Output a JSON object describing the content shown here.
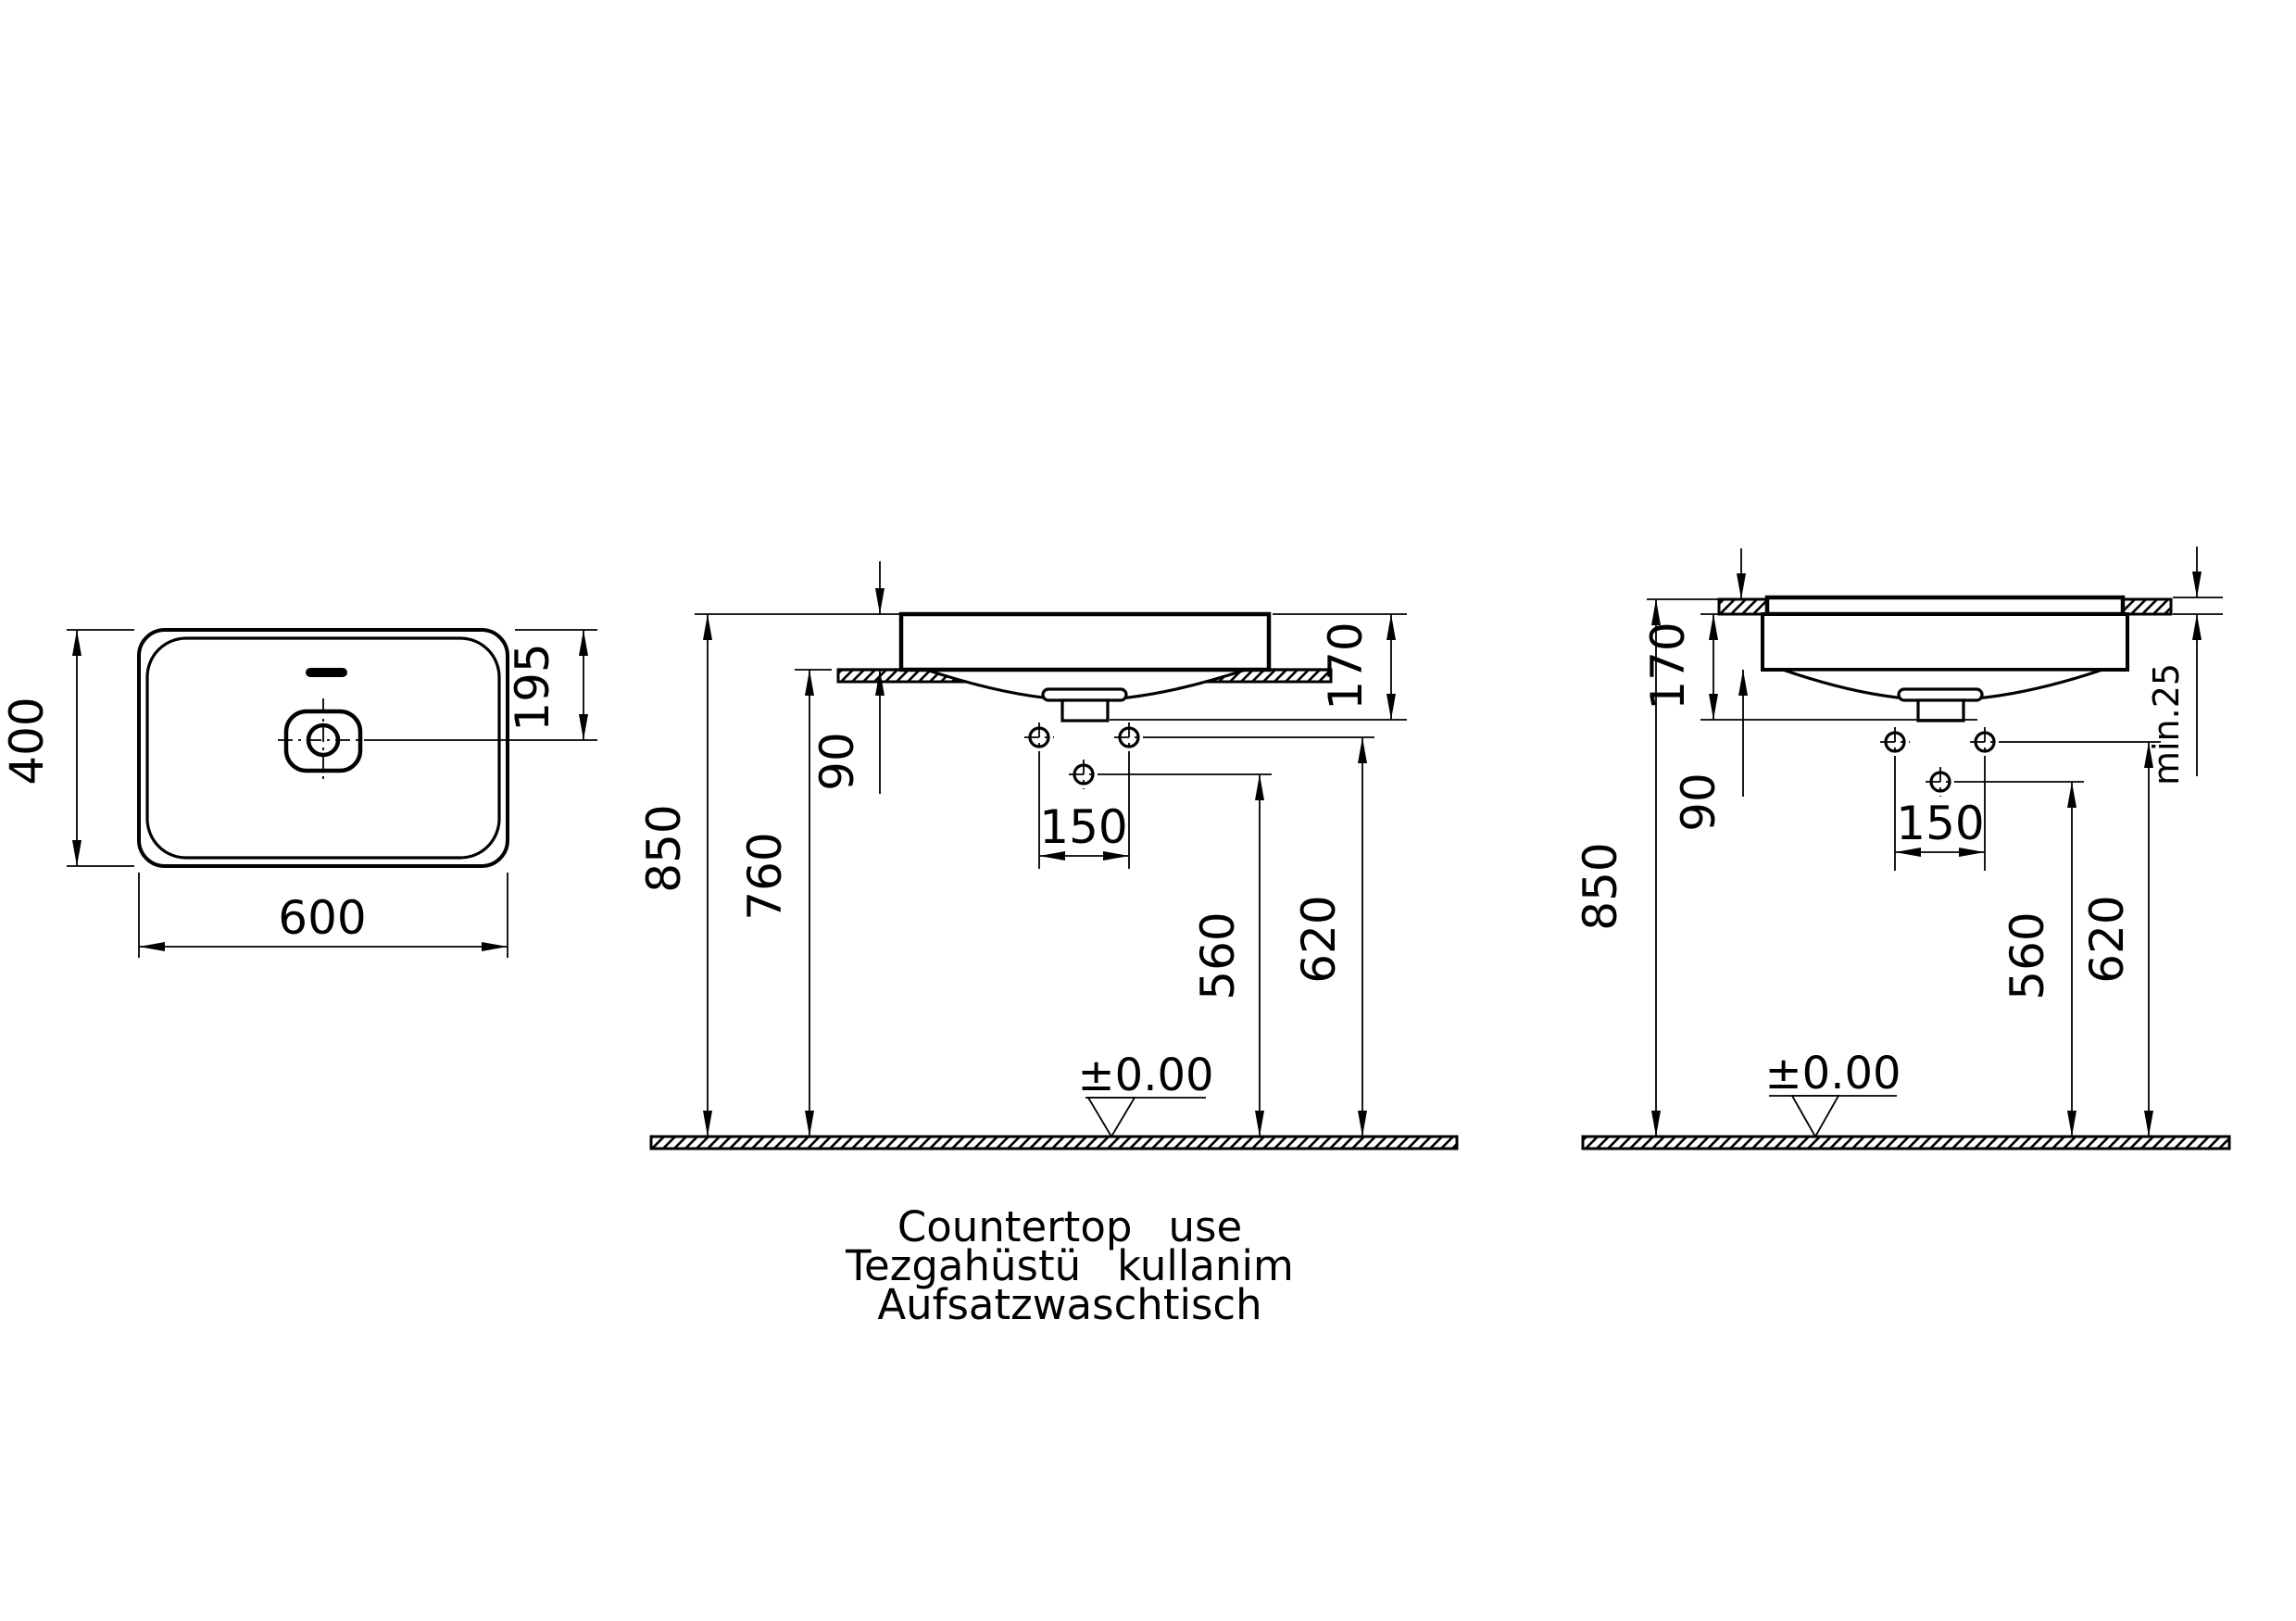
{
  "colors": {
    "line": "#000000",
    "background": "#ffffff"
  },
  "top_view": {
    "width": "600",
    "depth": "400",
    "drain_offset": "195"
  },
  "front_view": {
    "height_rim_from_floor": "850",
    "height_countertop": "760",
    "rim_above_countertop": "90",
    "basin_total_depth": "170",
    "faucet_hole_spacing": "150",
    "center_hole_height": "560",
    "side_hole_height": "620",
    "floor_datum": "±0.00"
  },
  "recessed_view": {
    "height_rim_from_floor": "850",
    "rim_above_countertop": "90",
    "basin_total_depth": "170",
    "faucet_hole_spacing": "150",
    "center_hole_height": "560",
    "side_hole_height": "620",
    "min_countertop_thickness": "min.25",
    "floor_datum": "±0.00"
  },
  "caption": {
    "line_en": "Countertop use",
    "line_tr": "Tezgahüstü kullanim",
    "line_de": "Aufsatzwaschtisch"
  }
}
